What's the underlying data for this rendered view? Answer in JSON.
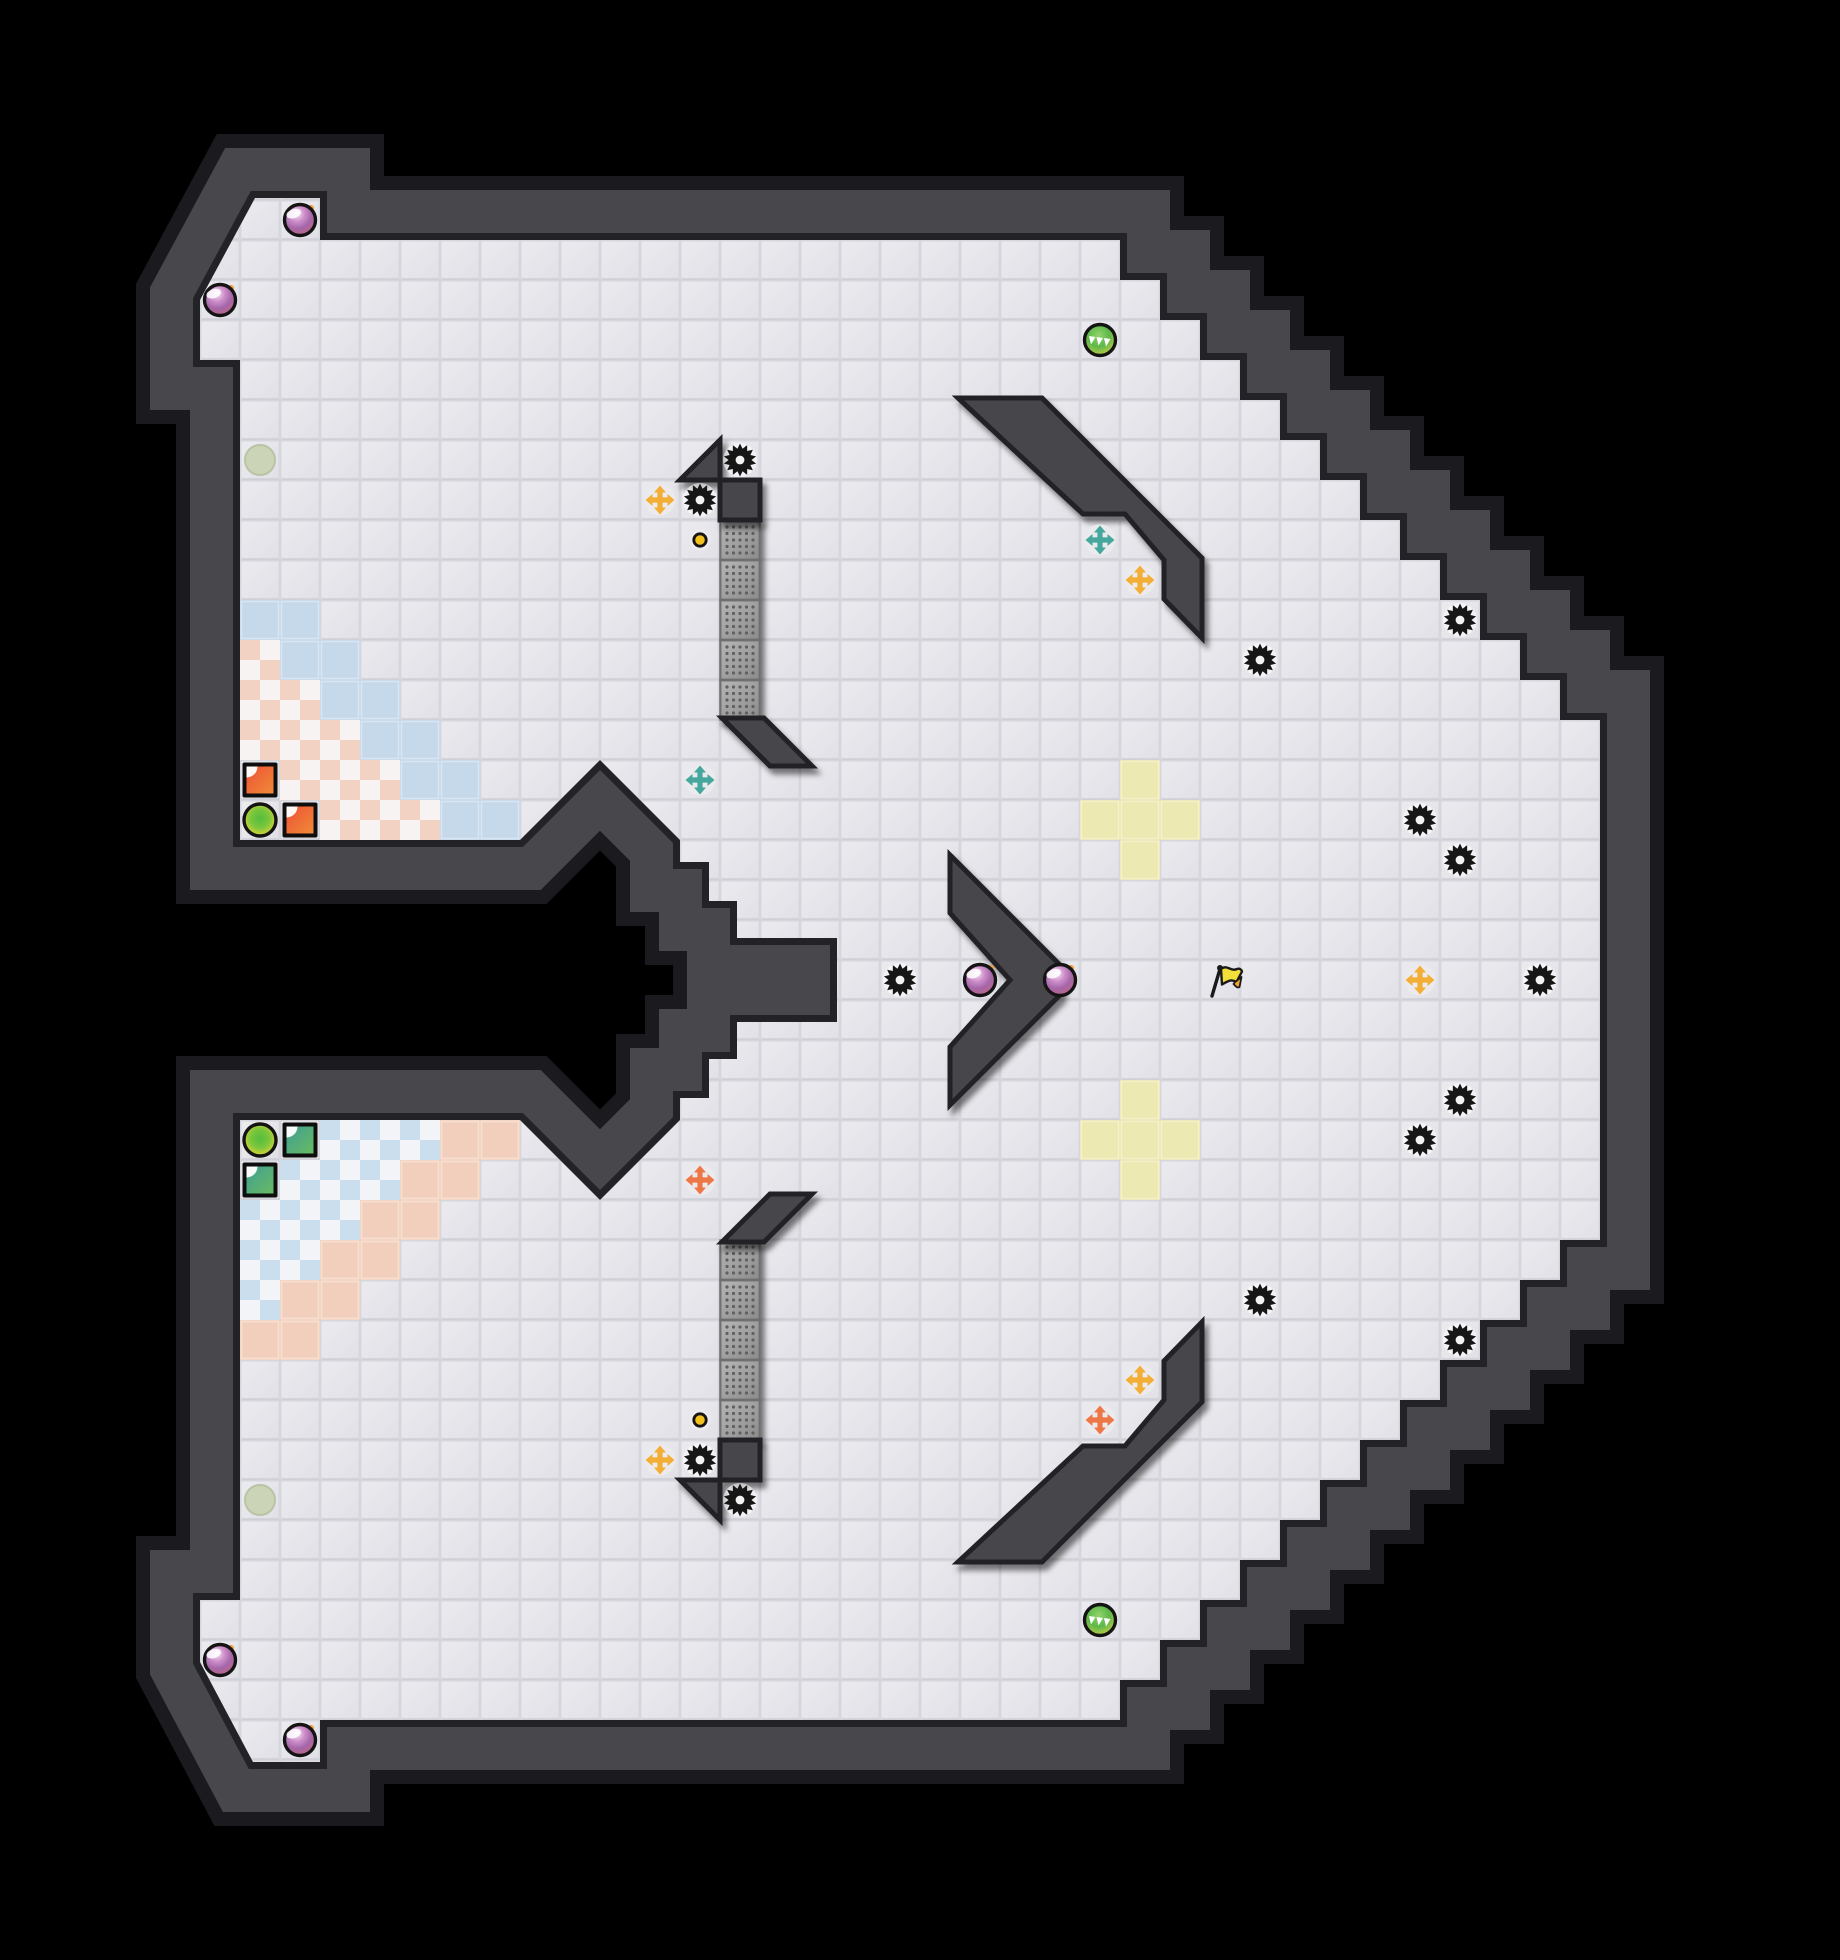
{
  "meta": {
    "title": "tagpro-style-map-preview",
    "canvas": {
      "width": 1840,
      "height": 1960
    },
    "tile_size": 40
  },
  "colors": {
    "outside": "#000000",
    "wall": "#47474c",
    "wall_outline": "#232327",
    "wall_edge": "#1b1b1f",
    "floor_gap": "#d6d6dd",
    "floor_hi": "#ebebf0",
    "floor_lo": "#e0e0e6",
    "blue_team": "#c5d9ea",
    "red_team": "#f2cfbd",
    "yellow_tile": "#ece9b2",
    "endzone_red_a": "#f2d2c2",
    "endzone_red_b": "#f6f3f2",
    "endzone_blue_a": "#cadeee",
    "endzone_blue_b": "#f3f4f7",
    "gate_hi": "#b5b5b5",
    "gate_lo": "#8c8c8c",
    "gate_dot": "#616161",
    "gate_border": "#6e6e6e",
    "spike": "#161616",
    "spike_hole": "#f2f2f4",
    "bomb_hi": "#f6ecf5",
    "bomb_mid": "#a465a8",
    "bomb_low": "#c6677f",
    "bomb_fuse": "#ef9d2f",
    "power_hi": "#93d46d",
    "power_mid": "#5cb84a",
    "power_low": "#d2d23f",
    "portal_green": "#55bd3c",
    "portal_yellow": "#e4e03a",
    "portal_off": "#cbd4b6",
    "portal_off_edge": "#b9c3a6",
    "button_yellow": "#f2c11e",
    "pad": "#ebebee",
    "boost_yellow": "#f2ae35",
    "boost_teal": "#46a79f",
    "boost_orange": "#ee7748",
    "flag_red_a": "#ee5136",
    "flag_red_b": "#f08b38",
    "flag_blue_a": "#3f9f92",
    "flag_blue_b": "#68bb62",
    "flag_station_bg": "#0e0e0e",
    "neutral_flag": "#f2df3a",
    "neutral_flag_fold": "#f2a233",
    "ink": "#1a1a1a"
  },
  "geometry": {
    "floor_outline": [
      [
        255,
        198
      ],
      [
        320,
        198
      ],
      [
        320,
        240
      ],
      [
        1120,
        240
      ],
      [
        1120,
        280
      ],
      [
        1160,
        280
      ],
      [
        1160,
        320
      ],
      [
        1200,
        320
      ],
      [
        1200,
        360
      ],
      [
        1240,
        360
      ],
      [
        1240,
        400
      ],
      [
        1280,
        400
      ],
      [
        1280,
        440
      ],
      [
        1320,
        440
      ],
      [
        1320,
        480
      ],
      [
        1360,
        480
      ],
      [
        1360,
        520
      ],
      [
        1400,
        520
      ],
      [
        1400,
        560
      ],
      [
        1440,
        560
      ],
      [
        1440,
        600
      ],
      [
        1480,
        600
      ],
      [
        1480,
        640
      ],
      [
        1520,
        640
      ],
      [
        1520,
        680
      ],
      [
        1560,
        680
      ],
      [
        1560,
        720
      ],
      [
        1600,
        720
      ],
      [
        1600,
        1240
      ],
      [
        1560,
        1240
      ],
      [
        1560,
        1280
      ],
      [
        1520,
        1280
      ],
      [
        1520,
        1320
      ],
      [
        1480,
        1320
      ],
      [
        1480,
        1360
      ],
      [
        1440,
        1360
      ],
      [
        1440,
        1400
      ],
      [
        1400,
        1400
      ],
      [
        1400,
        1440
      ],
      [
        1360,
        1440
      ],
      [
        1360,
        1480
      ],
      [
        1320,
        1480
      ],
      [
        1320,
        1520
      ],
      [
        1280,
        1520
      ],
      [
        1280,
        1560
      ],
      [
        1240,
        1560
      ],
      [
        1240,
        1600
      ],
      [
        1200,
        1600
      ],
      [
        1200,
        1640
      ],
      [
        1160,
        1640
      ],
      [
        1160,
        1680
      ],
      [
        1120,
        1680
      ],
      [
        1120,
        1720
      ],
      [
        320,
        1720
      ],
      [
        320,
        1762
      ],
      [
        253,
        1762
      ],
      [
        200,
        1662
      ],
      [
        200,
        1600
      ],
      [
        240,
        1600
      ],
      [
        240,
        1120
      ],
      [
        520,
        1120
      ],
      [
        600,
        1200
      ],
      [
        680,
        1120
      ],
      [
        680,
        1098
      ],
      [
        709,
        1098
      ],
      [
        709,
        1059
      ],
      [
        737,
        1059
      ],
      [
        737,
        1022
      ],
      [
        837,
        1022
      ],
      [
        837,
        938
      ],
      [
        737,
        938
      ],
      [
        737,
        901
      ],
      [
        709,
        901
      ],
      [
        709,
        862
      ],
      [
        680,
        862
      ],
      [
        680,
        840
      ],
      [
        600,
        760
      ],
      [
        520,
        840
      ],
      [
        240,
        840
      ],
      [
        240,
        360
      ],
      [
        200,
        360
      ],
      [
        200,
        300
      ]
    ],
    "inner_walls": [
      {
        "name": "ne-diagonal-wall",
        "points": [
          [
            958,
            398
          ],
          [
            1042,
            398
          ],
          [
            1202,
            558
          ],
          [
            1202,
            638
          ],
          [
            1164,
            599
          ],
          [
            1164,
            560
          ],
          [
            1125,
            514
          ],
          [
            1083,
            514
          ]
        ]
      },
      {
        "name": "se-diagonal-wall",
        "points": [
          [
            958,
            1562
          ],
          [
            1042,
            1562
          ],
          [
            1202,
            1402
          ],
          [
            1202,
            1322
          ],
          [
            1164,
            1361
          ],
          [
            1164,
            1400
          ],
          [
            1125,
            1446
          ],
          [
            1083,
            1446
          ]
        ]
      },
      {
        "name": "center-chevron-wall",
        "points": [
          [
            950,
            855
          ],
          [
            1060,
            965
          ],
          [
            1060,
            995
          ],
          [
            950,
            1105
          ],
          [
            950,
            1047
          ],
          [
            1010,
            980
          ],
          [
            950,
            913
          ]
        ]
      },
      {
        "name": "top-gate-diagonal",
        "points": [
          [
            722,
            718
          ],
          [
            764,
            718
          ],
          [
            812,
            766
          ],
          [
            770,
            766
          ]
        ]
      },
      {
        "name": "bottom-gate-diagonal",
        "points": [
          [
            722,
            1242
          ],
          [
            764,
            1242
          ],
          [
            812,
            1194
          ],
          [
            770,
            1194
          ]
        ]
      },
      {
        "name": "top-wall-triangle",
        "points": [
          [
            680,
            480
          ],
          [
            720,
            480
          ],
          [
            720,
            440
          ]
        ]
      },
      {
        "name": "bottom-wall-triangle",
        "points": [
          [
            680,
            1480
          ],
          [
            720,
            1480
          ],
          [
            720,
            1520
          ]
        ]
      }
    ],
    "wall_blocks": [
      {
        "x": 720,
        "y": 480
      },
      {
        "x": 720,
        "y": 1440
      }
    ],
    "gate_tiles": [
      [
        18,
        13
      ],
      [
        18,
        14
      ],
      [
        18,
        15
      ],
      [
        18,
        16
      ],
      [
        18,
        17
      ],
      [
        18,
        31
      ],
      [
        18,
        32
      ],
      [
        18,
        33
      ],
      [
        18,
        34
      ],
      [
        18,
        35
      ]
    ]
  },
  "tiles": {
    "blue_team": [
      [
        6,
        15
      ],
      [
        7,
        15
      ],
      [
        7,
        16
      ],
      [
        8,
        16
      ],
      [
        8,
        17
      ],
      [
        9,
        17
      ],
      [
        9,
        18
      ],
      [
        10,
        18
      ],
      [
        10,
        19
      ],
      [
        11,
        19
      ],
      [
        11,
        20
      ],
      [
        12,
        20
      ]
    ],
    "red_team": [
      [
        6,
        33
      ],
      [
        7,
        33
      ],
      [
        7,
        32
      ],
      [
        8,
        32
      ],
      [
        8,
        31
      ],
      [
        9,
        31
      ],
      [
        9,
        30
      ],
      [
        10,
        30
      ],
      [
        10,
        29
      ],
      [
        11,
        29
      ],
      [
        11,
        28
      ],
      [
        12,
        28
      ]
    ],
    "endzone_red": [
      [
        6,
        16
      ],
      [
        6,
        17
      ],
      [
        7,
        17
      ],
      [
        6,
        18
      ],
      [
        7,
        18
      ],
      [
        8,
        18
      ],
      [
        7,
        19
      ],
      [
        8,
        19
      ],
      [
        9,
        19
      ],
      [
        8,
        20
      ],
      [
        9,
        20
      ],
      [
        10,
        20
      ]
    ],
    "endzone_blue": [
      [
        6,
        32
      ],
      [
        6,
        31
      ],
      [
        7,
        31
      ],
      [
        6,
        30
      ],
      [
        7,
        30
      ],
      [
        8,
        30
      ],
      [
        7,
        29
      ],
      [
        8,
        29
      ],
      [
        9,
        29
      ],
      [
        8,
        28
      ],
      [
        9,
        28
      ],
      [
        10,
        28
      ]
    ],
    "yellow": [
      [
        28,
        19
      ],
      [
        27,
        20
      ],
      [
        28,
        20
      ],
      [
        29,
        20
      ],
      [
        28,
        21
      ],
      [
        28,
        27
      ],
      [
        27,
        28
      ],
      [
        28,
        28
      ],
      [
        29,
        28
      ],
      [
        28,
        29
      ]
    ]
  },
  "objects": {
    "spikes": [
      [
        17,
        12
      ],
      [
        18,
        11
      ],
      [
        31,
        16
      ],
      [
        36,
        15
      ],
      [
        35,
        20
      ],
      [
        36,
        21
      ],
      [
        22,
        24
      ],
      [
        38,
        24
      ],
      [
        36,
        27
      ],
      [
        35,
        28
      ],
      [
        31,
        32
      ],
      [
        36,
        33
      ],
      [
        17,
        36
      ],
      [
        18,
        37
      ]
    ],
    "bombs": [
      [
        7,
        5
      ],
      [
        5,
        7
      ],
      [
        24,
        24
      ],
      [
        26,
        24
      ],
      [
        5,
        41
      ],
      [
        7,
        43
      ]
    ],
    "powerups": [
      [
        27,
        8
      ],
      [
        27,
        40
      ]
    ],
    "portals": [
      [
        6,
        20
      ],
      [
        6,
        28
      ]
    ],
    "inactive_portals": [
      [
        6,
        11
      ],
      [
        6,
        37
      ]
    ],
    "buttons": [
      [
        17,
        13
      ],
      [
        17,
        35
      ]
    ],
    "boosts": {
      "yellow": [
        [
          16,
          12
        ],
        [
          28,
          14
        ],
        [
          35,
          24
        ],
        [
          28,
          34
        ],
        [
          16,
          36
        ]
      ],
      "teal": [
        [
          27,
          13
        ],
        [
          17,
          19
        ]
      ],
      "orange": [
        [
          17,
          29
        ],
        [
          27,
          35
        ]
      ]
    },
    "team_flags": {
      "red": [
        [
          6,
          19
        ],
        [
          7,
          20
        ]
      ],
      "blue": [
        [
          7,
          28
        ],
        [
          6,
          29
        ]
      ]
    },
    "neutral_flag": [
      30,
      24
    ]
  },
  "legend": {
    "spike-icon": "gear-shaped spike hazard",
    "bomb-icon": "purple bomb orb with fuse",
    "powerup-icon": "green powerup orb with white chevrons",
    "portal-icon": "yellow-green portal circle",
    "inactive-portal-icon": "pale inactive portal circle",
    "button-icon": "small yellow button dot",
    "boost-icon": "four-way arrow boost pad",
    "red-flag-station-icon": "red square tile with folded white corner",
    "blue-flag-station-icon": "teal square tile with folded white corner",
    "neutral-flag-icon": "yellow pennant flag on pole",
    "gate-tile": "dotted grey gate tile",
    "wall": "dark grey wall",
    "floor": "light grey tiled floor"
  }
}
